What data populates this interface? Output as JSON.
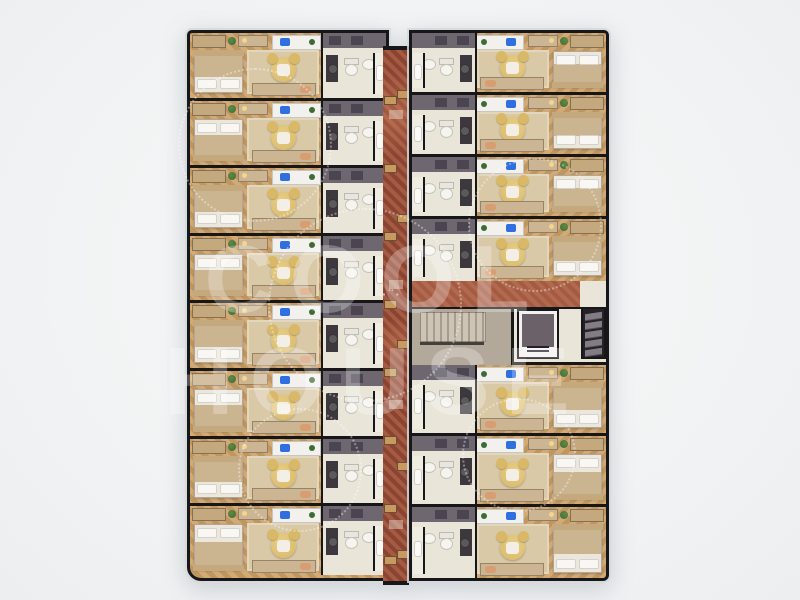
{
  "scene": {
    "type": "architectural floor plan render, top-down view of residential/hotel floor",
    "watermark": {
      "line1": "COOL",
      "line2": "HOUSE",
      "mark": "·¨·"
    }
  },
  "palette": {
    "bg": "#f1f3f4",
    "wall": "#17171a",
    "wood_a": "#d2aa78",
    "wood_b": "#c0965f",
    "rug": "#d9c9a7",
    "corridor_a": "#a65a42",
    "corridor_b": "#8a4432",
    "corridor_c": "#b06a50",
    "bath_floor": "#e9e5d8",
    "bath_wall": "#6e6770",
    "bath_panel": "#4a4550",
    "vanity": "#3c383d",
    "fixture": "#f6f4ee",
    "bed_frame": "#c4a87e",
    "blanket": "#cbb490",
    "mattress": "#ece7dd",
    "pillow": "#f8f7f3",
    "chair": "#d9b968",
    "cushion": "#f3efe6",
    "bench": "#cbb592",
    "accent_pillow": "#d99d72",
    "laptop": "#2f6fe0",
    "plant": "#3e6b34",
    "stair_floor": "#b3a99b",
    "tread_a": "#cdc4b5",
    "tread_b": "#a79d8e",
    "elevator_cab": "#6b6269",
    "elevator_frame": "#f2f1ef",
    "shelf_dark": "#242226",
    "shelf_slat": "#837b85",
    "door": "#c89a5f",
    "wm": "rgba(255,255,255,0.30)"
  },
  "floorplan": {
    "left_column": {
      "unit_count": 8
    },
    "right_column": {
      "top_unit_count": 4,
      "bottom_unit_count": 3
    },
    "core": {
      "rooms": [
        "stairwell",
        "elevator",
        "storage-shelves",
        "landing"
      ]
    },
    "unit_rooms": [
      "sleeping-area",
      "lounge-area",
      "work-desk",
      "bathroom"
    ],
    "unit_furniture": [
      "bed",
      "lounge-chair",
      "tv-bench",
      "desk",
      "laptop",
      "plant",
      "wardrobe",
      "vanity",
      "toilet",
      "sink",
      "shower"
    ]
  }
}
